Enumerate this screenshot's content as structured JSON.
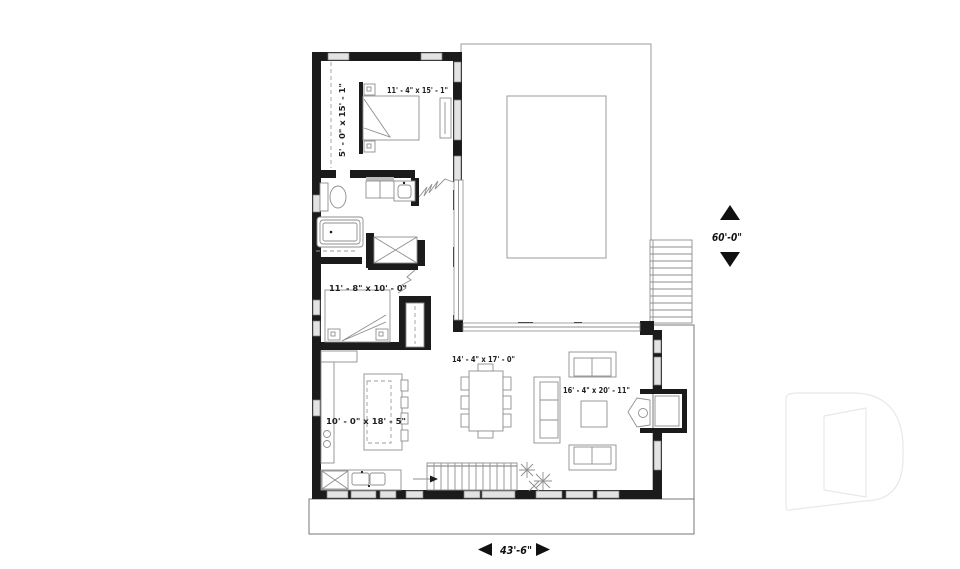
{
  "rooms": {
    "bedroom_primary": "11' - 4\" x 15' - 1\"",
    "bedroom_primary_closet": "5' - 0\" x 15' - 1\"",
    "bedroom_second": "11' - 8\" x 10' - 0\"",
    "dining": "14' - 4\" x 17' - 0\"",
    "kitchen": "10' - 0\" x 18' - 5\"",
    "living": "16' - 4\" x 20' - 11\""
  },
  "overall_dimensions": {
    "depth": "60'-0\"",
    "width": "43'-6\""
  },
  "colors": {
    "wall": "#1b1b1b",
    "furniture_line": "#8f8f8f",
    "watermark": "#e8e8e8",
    "text": "#111111"
  }
}
